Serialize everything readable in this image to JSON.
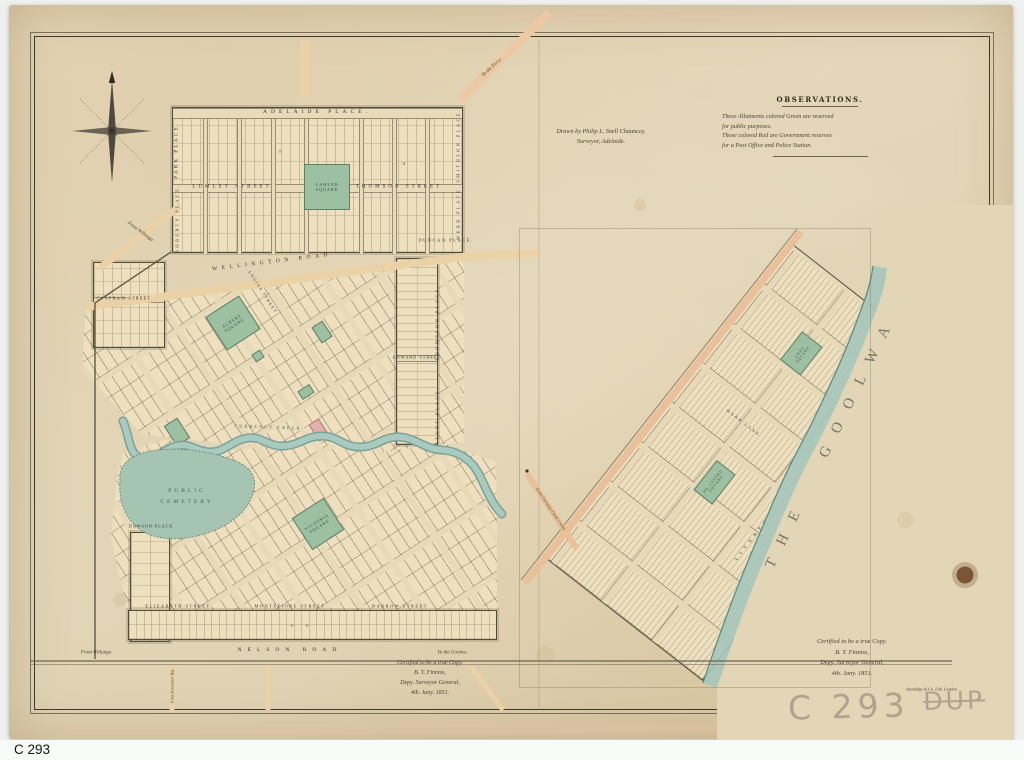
{
  "caption": "C 293",
  "stamp": {
    "number": "C 293",
    "suffix": "DUP"
  },
  "notes": {
    "drawn_by_1": "Drawn by Philip L. Snell Chauncey,",
    "drawn_by_2": "Surveyor, Adelaide.",
    "observations_title": "OBSERVATIONS.",
    "observations_lines": [
      "These Allotments colored Green are reserved",
      "for public purposes.",
      "Those colored Red are Government reserves",
      "for a Post Office and Police Station."
    ],
    "certification": [
      "Certified to be a true Copy.",
      "B. T. Finniss,",
      "Depy. Surveyor General,",
      "4th. Jany. 1851."
    ],
    "lithographer": "Standidge & Co. Lith. London."
  },
  "left_map": {
    "places": {
      "adelaide_place": "ADELAIDE PLACE.",
      "park_place": "PARK PLACE.",
      "roberts_place": "ROBERTS PLACE.",
      "smithson_place": "SMITHSON PLACE.",
      "webb_place": "WEBB PLACE.",
      "duncan_place": "DUNCAN PLACE.",
      "dawson_place": "DAWSON PLACE.",
      "thompson_place": "THOMPSON PLACE.",
      "sturt_place": "STURT PLACE."
    },
    "streets": {
      "lumley": "LUMLEY STREET",
      "thomson": "THOMSON STREET",
      "wellington": "WELLINGTON ROAD",
      "clapham": "CLAPHAM STREET",
      "louisa": "LOUISA STREET",
      "edward": "EDWARD STREET",
      "elizabeth": "ELIZABETH STREET",
      "montefiore": "MONTEFIORE STREET",
      "barrow": "BARROW STREET",
      "nelson": "NELSON ROAD"
    },
    "squares": {
      "gawler": "GAWLER SQUARE",
      "albert": "ALBERT SQUARE",
      "victoria": "VICTORIA SQUARE"
    },
    "features": {
      "cemetery": "PUBLIC CEMETERY",
      "currency_creek": "CURRENCY CREEK"
    },
    "annotations": {
      "to_the_ferry": "To the Ferry",
      "from_willunga": "From Willunga",
      "to_the_goolwa": "To the Goolwa",
      "from_encounter_bay": "From Encounter Bay"
    }
  },
  "right_map": {
    "squares": {
      "gray": "GRAY SQUARE",
      "decastro": "DE CASTRO SQUARE"
    },
    "streets": {
      "mark_lane": "MARK LANE",
      "liverpool": "LIVERPOOL",
      "road": "ROAD"
    },
    "water": "THE GOOLWA",
    "annotations": {
      "from_currency_creek": "From Currency Creek 2 miles"
    }
  },
  "marks": {
    "cross": "×"
  }
}
